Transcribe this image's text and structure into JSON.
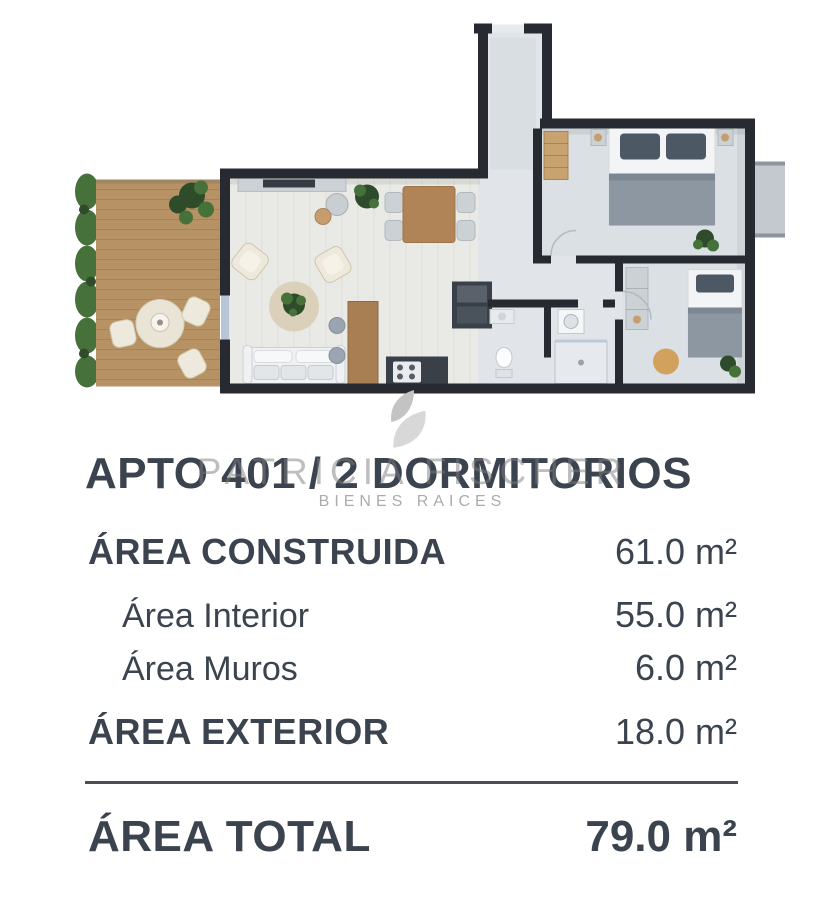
{
  "title": "APTO 401 / 2 DORMITORIOS",
  "watermark": {
    "icon": "leaf-logo",
    "line1": "PATRICIA FISCHER",
    "line2": "BIENES RAICES"
  },
  "areas": {
    "construida": {
      "label": "ÁREA CONSTRUIDA",
      "value": "61.0 m²"
    },
    "interior": {
      "label": "Área Interior",
      "value": "55.0 m²"
    },
    "muros": {
      "label": "Área Muros",
      "value": "6.0 m²"
    },
    "exterior": {
      "label": "ÁREA EXTERIOR",
      "value": "18.0 m²"
    },
    "total": {
      "label": "ÁREA TOTAL",
      "value": "79.0 m²"
    }
  },
  "colors": {
    "text": "#3b434e",
    "divider": "#4a4f56",
    "wall": "#272b31",
    "floor": "#e1e4e8",
    "floorB": "#dbe0e5",
    "livingFloor": "#e9eae5",
    "deck": "#b69264",
    "wood": "#b08457",
    "counter": "#3a4047",
    "blanket": "#8c97a2",
    "pillow": "#4c5864",
    "plant": "#47713a",
    "plantD": "#2e4b2a",
    "glass": "#b7c6d6",
    "watermark": "#c9c9c9"
  }
}
